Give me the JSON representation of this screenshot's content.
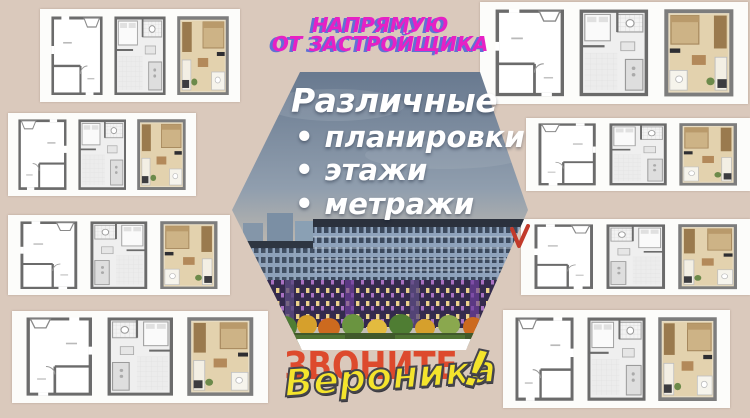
{
  "background_color": "#dac9bc",
  "promo": {
    "line1": "НАПРЯМУЮ",
    "line2": "ОТ ЗАСТРОЙЩИКА",
    "text_color": "#e621c5",
    "shadow_color": "#6070d5"
  },
  "hexagon": {
    "title": "Различные",
    "bullet_char": "•",
    "bullets": [
      "планировки",
      "этажи",
      "метражи"
    ],
    "text_color": "#ffffff",
    "sky_top_color": "#68798f",
    "sky_bottom_color": "#bcb7af"
  },
  "building_photo": {
    "facade_upper_color": "#8fa3bc",
    "facade_lower_color": "#382e52",
    "trees_colors": [
      "#4f7d33",
      "#d6a02c",
      "#cc6a1f",
      "#6a9440"
    ],
    "lawn_color": "#41592b"
  },
  "call_to_action": {
    "call": "ЗВОНИТЕ",
    "call_color": "#dd4a2d",
    "agent_name": "Вероника",
    "exclamation": "!",
    "name_color": "#f4e42c",
    "name_outline_color": "#45454c"
  },
  "red_mark": {
    "shape": "checkmark",
    "color": "#c23a2a"
  },
  "floor_plan_cards": [
    {
      "position": "top-left",
      "panels": [
        "outline-floorplan",
        "furnished-floorplan",
        "render-floorplan"
      ]
    },
    {
      "position": "middle-left-1",
      "panels": [
        "outline-floorplan",
        "furnished-floorplan",
        "render-floorplan"
      ]
    },
    {
      "position": "middle-left-2",
      "panels": [
        "outline-floorplan",
        "furnished-floorplan",
        "render-floorplan"
      ]
    },
    {
      "position": "bottom-left",
      "panels": [
        "outline-floorplan",
        "furnished-floorplan",
        "render-floorplan"
      ]
    },
    {
      "position": "top-right",
      "panels": [
        "outline-floorplan",
        "furnished-floorplan",
        "render-floorplan"
      ]
    },
    {
      "position": "middle-right-1",
      "panels": [
        "outline-floorplan",
        "furnished-floorplan",
        "render-floorplan"
      ]
    },
    {
      "position": "middle-right-2",
      "panels": [
        "outline-floorplan",
        "furnished-floorplan",
        "render-floorplan"
      ]
    },
    {
      "position": "bottom-right",
      "panels": [
        "outline-floorplan",
        "furnished-floorplan",
        "render-floorplan"
      ]
    }
  ]
}
